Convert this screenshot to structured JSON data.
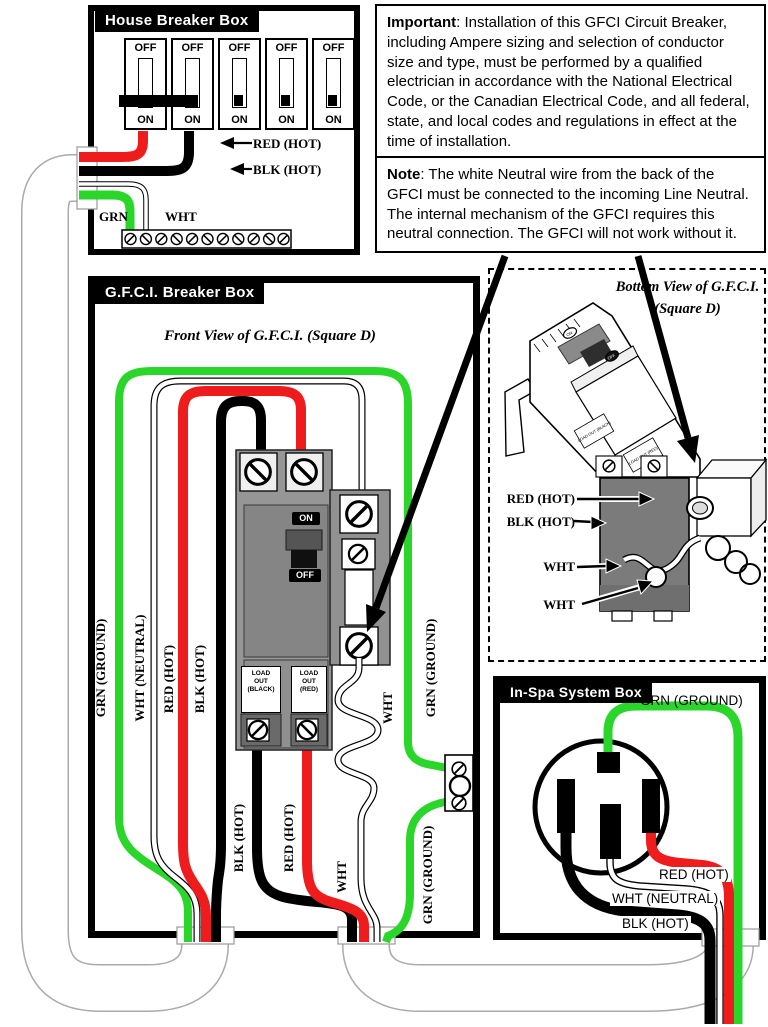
{
  "colors": {
    "red": "#ee1c1c",
    "green": "#2bd62b",
    "black": "#000000",
    "breaker_gray": "#969696",
    "conduit_gray": "#aaaaaa"
  },
  "house_box": {
    "title": "House Breaker Box",
    "breaker_count": 5,
    "breaker_off_label": "OFF",
    "breaker_on_label": "ON",
    "labels": {
      "red_hot": "RED (HOT)",
      "blk_hot": "BLK (HOT)",
      "grn": "GRN",
      "wht": "WHT"
    }
  },
  "important_box": {
    "lead": "Important",
    "text": ": Installation of this GFCI Circuit Breaker, including Ampere sizing and selection of conductor size and type, must be performed by a qualified electrician in accordance with the National Electrical Code, or the Canadian Electrical Code, and all federal, state, and local codes and regulations in effect at the time of installation."
  },
  "note_box": {
    "lead": "Note",
    "text": ": The white Neutral wire from the back of the GFCI must be connected to the incoming Line Neutral. The internal mechanism of the GFCI requires this neutral connection. The GFCI will not work without it."
  },
  "gfci_box": {
    "title": "G.F.C.I. Breaker Box",
    "subtitle": "Front View of G.F.C.I. (Square D)",
    "left_labels": [
      "GRN (GROUND)",
      "WHT (NEUTRAL)",
      "RED (HOT)",
      "BLK (HOT)"
    ],
    "breaker": {
      "on": "ON",
      "off": "OFF",
      "load_out_black": [
        "LOAD",
        "OUT",
        "(BLACK)"
      ],
      "load_out_red": [
        "LOAD",
        "OUT",
        "(RED)"
      ]
    },
    "right_labels": {
      "grn_upper": "GRN (GROUND)",
      "wht_pigtail": "WHT",
      "grn_lower": "GRN (GROUND)"
    },
    "bottom_labels": {
      "blk": "BLK (HOT)",
      "red": "RED (HOT)",
      "wht": "WHT"
    }
  },
  "bottom_view": {
    "title": "Bottom View of G.F.C.I.",
    "subtitle": "(Square D)",
    "labels": {
      "red": "RED (HOT)",
      "blk": "BLK (HOT)",
      "wht1": "WHT",
      "wht2": "WHT"
    },
    "iso_labels": {
      "load_out_black": "LOAD OUT (BLACK)",
      "load_out_red": "LOAD OUT (RED)",
      "on": "ON",
      "off": "OFF"
    }
  },
  "inspa_box": {
    "title": "In-Spa System Box",
    "labels": {
      "grn": "GRN (GROUND)",
      "red": "RED (HOT)",
      "wht": "WHT (NEUTRAL)",
      "blk": "BLK (HOT)"
    }
  }
}
